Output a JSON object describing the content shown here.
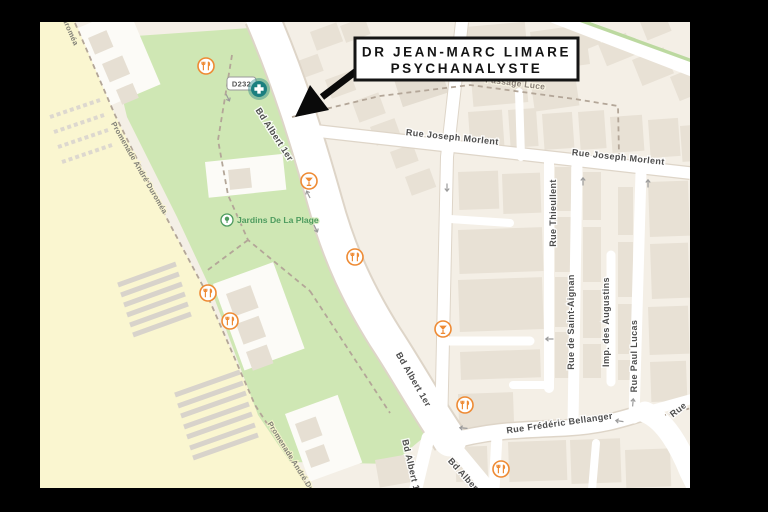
{
  "annotation": {
    "line1": "DR JEAN-MARC LIMARE",
    "line2": "PSYCHANALYSTE"
  },
  "road_badge": "D232",
  "park_label": "Jardins De La Plage",
  "streets": {
    "bd_albert": "Bd Albert 1er",
    "joseph_morlent": "Rue Joseph Morlent",
    "thieullent": "Rue Thieullent",
    "saint_aignan": "Rue de Saint-Aignan",
    "augustins": "Imp. des Augustins",
    "paul_lucas": "Rue Paul Lucas",
    "bellanger": "Rue Frédéric Bellanger",
    "passage_luce": "Passage Luce",
    "promenade": "Promenade André Duroméa",
    "rue_partial": "Rue"
  },
  "icons": {
    "pharmacy": "pharmacy-cross-icon",
    "restaurant": "restaurant-icon",
    "bar": "cocktail-icon",
    "park": "park-tree-icon",
    "one_way": "one-way-arrow-icon",
    "pointer": "annotation-arrow"
  },
  "colors": {
    "background": "#000000",
    "land": "#f4efe6",
    "beach": "#faf6d0",
    "park": "#cfe7b4",
    "road": "#ffffff",
    "building": "#e8e1d5",
    "poi_orange": "#ee8a33",
    "pharmacy_teal": "#1b7f7f",
    "street_text": "#4d4d4d",
    "park_text": "#4e9b5f",
    "annotation_border": "#141414"
  }
}
